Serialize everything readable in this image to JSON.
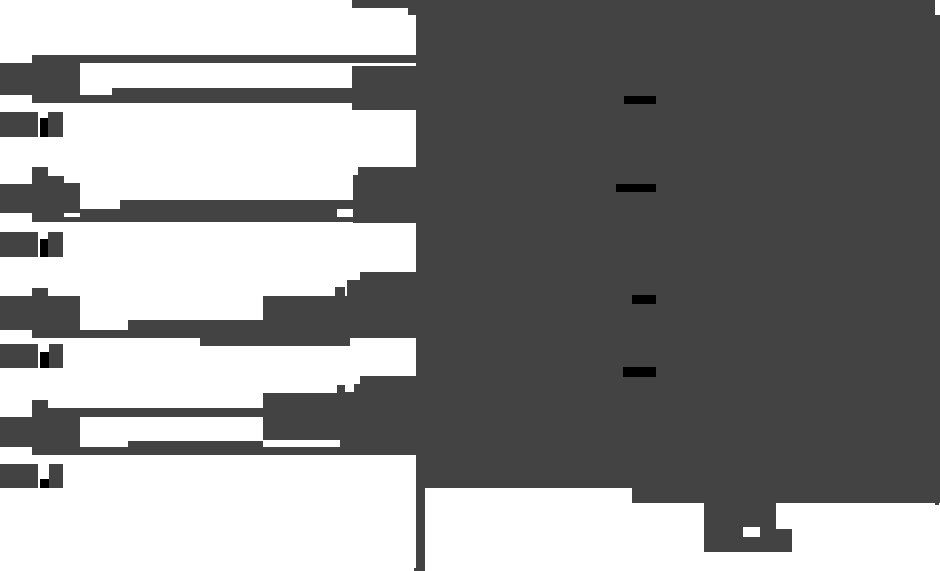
{
  "canvas": {
    "width": 940,
    "height": 571,
    "background": "#ffffff",
    "alt": "Pixelated monochrome silhouette of a web page: four list items with icon blocks and text lines on the left, large dark display panel with black text dashes and a monitor stand on the right"
  },
  "palette": {
    "dark": "#434343",
    "black": "#000000",
    "white": "#ffffff"
  },
  "shapes": [
    {
      "name": "panel-top-edge",
      "x": 352,
      "y": 0,
      "w": 583,
      "h": 8,
      "color": "dark"
    },
    {
      "name": "panel-top-step",
      "x": 408,
      "y": 8,
      "w": 527,
      "h": 7,
      "color": "dark"
    },
    {
      "name": "panel-body",
      "x": 416,
      "y": 15,
      "w": 524,
      "h": 473,
      "color": "dark"
    },
    {
      "name": "panel-bottom-extension",
      "x": 632,
      "y": 488,
      "w": 308,
      "h": 15,
      "color": "dark"
    },
    {
      "name": "panel-corner-nub",
      "x": 935,
      "y": 503,
      "w": 4,
      "h": 2,
      "color": "dark"
    },
    {
      "name": "divider-line",
      "x": 416,
      "y": 488,
      "w": 9,
      "h": 80,
      "color": "dark"
    },
    {
      "name": "divider-line-foot",
      "x": 414,
      "y": 568,
      "w": 11,
      "h": 3,
      "color": "dark"
    },
    {
      "name": "stand-column",
      "x": 704,
      "y": 503,
      "w": 72,
      "h": 26,
      "color": "dark"
    },
    {
      "name": "stand-base",
      "x": 704,
      "y": 529,
      "w": 88,
      "h": 23,
      "color": "dark"
    },
    {
      "name": "stand-base-notch",
      "x": 743,
      "y": 527,
      "w": 17,
      "h": 10,
      "color": "white"
    },
    {
      "name": "screen-dash-1",
      "x": 624,
      "y": 96,
      "w": 32,
      "h": 8,
      "color": "black"
    },
    {
      "name": "screen-dash-2",
      "x": 616,
      "y": 184,
      "w": 40,
      "h": 8,
      "color": "black"
    },
    {
      "name": "screen-dash-3",
      "x": 632,
      "y": 295,
      "w": 24,
      "h": 9,
      "color": "black"
    },
    {
      "name": "screen-dash-4",
      "x": 623,
      "y": 367,
      "w": 33,
      "h": 10,
      "color": "black"
    },
    {
      "name": "item1-title-line",
      "x": 32,
      "y": 55,
      "w": 384,
      "h": 8,
      "color": "dark"
    },
    {
      "name": "item1-icon-block",
      "x": 32,
      "y": 55,
      "w": 48,
      "h": 48,
      "color": "dark"
    },
    {
      "name": "item1-left-block",
      "x": 0,
      "y": 63,
      "w": 32,
      "h": 32,
      "color": "dark"
    },
    {
      "name": "item1-text-line-a",
      "x": 112,
      "y": 88,
      "w": 241,
      "h": 7,
      "color": "dark"
    },
    {
      "name": "item1-text-line-b",
      "x": 32,
      "y": 95,
      "w": 321,
      "h": 8,
      "color": "dark"
    },
    {
      "name": "item1-connector",
      "x": 352,
      "y": 66,
      "w": 64,
      "h": 44,
      "color": "dark"
    },
    {
      "name": "item1-caption-block-a",
      "x": 0,
      "y": 112,
      "w": 38,
      "h": 25,
      "color": "dark"
    },
    {
      "name": "item1-caption-cursor",
      "x": 40,
      "y": 118,
      "w": 8,
      "h": 19,
      "color": "black"
    },
    {
      "name": "item1-caption-block-b",
      "x": 48,
      "y": 112,
      "w": 15,
      "h": 25,
      "color": "dark"
    },
    {
      "name": "item2-tab",
      "x": 32,
      "y": 167,
      "w": 16,
      "h": 9,
      "color": "dark"
    },
    {
      "name": "item2-icon-block",
      "x": 32,
      "y": 176,
      "w": 32,
      "h": 46,
      "color": "dark"
    },
    {
      "name": "item2-left-block",
      "x": 0,
      "y": 184,
      "w": 32,
      "h": 29,
      "color": "dark"
    },
    {
      "name": "item2-icon-block-b",
      "x": 64,
      "y": 183,
      "w": 16,
      "h": 30,
      "color": "dark"
    },
    {
      "name": "item2-text-line-a",
      "x": 120,
      "y": 200,
      "w": 233,
      "h": 9,
      "color": "dark"
    },
    {
      "name": "item2-text-line-b",
      "x": 80,
      "y": 209,
      "w": 257,
      "h": 8,
      "color": "dark"
    },
    {
      "name": "item2-text-line-c",
      "x": 32,
      "y": 217,
      "w": 384,
      "h": 5,
      "color": "dark"
    },
    {
      "name": "item2-connector-step",
      "x": 358,
      "y": 167,
      "w": 58,
      "h": 8,
      "color": "dark"
    },
    {
      "name": "item2-connector",
      "x": 353,
      "y": 175,
      "w": 63,
      "h": 48,
      "color": "dark"
    },
    {
      "name": "item2-caption-block-a",
      "x": 0,
      "y": 232,
      "w": 38,
      "h": 25,
      "color": "dark"
    },
    {
      "name": "item2-caption-cursor",
      "x": 40,
      "y": 239,
      "w": 9,
      "h": 18,
      "color": "black"
    },
    {
      "name": "item2-caption-block-b",
      "x": 48,
      "y": 232,
      "w": 15,
      "h": 25,
      "color": "dark"
    },
    {
      "name": "item3-tab",
      "x": 32,
      "y": 288,
      "w": 16,
      "h": 8,
      "color": "dark"
    },
    {
      "name": "item3-icon-block",
      "x": 0,
      "y": 296,
      "w": 80,
      "h": 34,
      "color": "dark"
    },
    {
      "name": "item3-text-line-a",
      "x": 128,
      "y": 320,
      "w": 135,
      "h": 10,
      "color": "dark"
    },
    {
      "name": "item3-heavy-block",
      "x": 263,
      "y": 296,
      "w": 153,
      "h": 42,
      "color": "dark"
    },
    {
      "name": "item3-text-line-b",
      "x": 32,
      "y": 330,
      "w": 384,
      "h": 8,
      "color": "dark"
    },
    {
      "name": "item3-text-line-b2",
      "x": 200,
      "y": 338,
      "w": 150,
      "h": 8,
      "color": "dark"
    },
    {
      "name": "item3-notch",
      "x": 335,
      "y": 287,
      "w": 10,
      "h": 9,
      "color": "dark"
    },
    {
      "name": "item3-connector-step-a",
      "x": 360,
      "y": 272,
      "w": 56,
      "h": 8,
      "color": "dark"
    },
    {
      "name": "item3-connector-step-b",
      "x": 347,
      "y": 280,
      "w": 69,
      "h": 16,
      "color": "dark"
    },
    {
      "name": "item3-caption-block-a",
      "x": 0,
      "y": 344,
      "w": 38,
      "h": 24,
      "color": "dark"
    },
    {
      "name": "item3-caption-cursor",
      "x": 40,
      "y": 352,
      "w": 9,
      "h": 16,
      "color": "black"
    },
    {
      "name": "item3-caption-block-b",
      "x": 49,
      "y": 344,
      "w": 14,
      "h": 24,
      "color": "dark"
    },
    {
      "name": "item4-connector-step-a",
      "x": 360,
      "y": 376,
      "w": 56,
      "h": 8,
      "color": "dark"
    },
    {
      "name": "item4-connector-step-b",
      "x": 354,
      "y": 384,
      "w": 62,
      "h": 8,
      "color": "dark"
    },
    {
      "name": "item4-connector",
      "x": 340,
      "y": 392,
      "w": 76,
      "h": 62,
      "color": "dark"
    },
    {
      "name": "item4-notch",
      "x": 337,
      "y": 385,
      "w": 8,
      "h": 8,
      "color": "dark"
    },
    {
      "name": "item4-heavy-block",
      "x": 263,
      "y": 393,
      "w": 97,
      "h": 47,
      "color": "dark"
    },
    {
      "name": "item4-tab",
      "x": 32,
      "y": 400,
      "w": 16,
      "h": 8,
      "color": "dark"
    },
    {
      "name": "item4-title-line",
      "x": 32,
      "y": 408,
      "w": 231,
      "h": 9,
      "color": "dark"
    },
    {
      "name": "item4-icon-block",
      "x": 32,
      "y": 408,
      "w": 48,
      "h": 47,
      "color": "dark"
    },
    {
      "name": "item4-left-block",
      "x": 0,
      "y": 417,
      "w": 32,
      "h": 30,
      "color": "dark"
    },
    {
      "name": "item4-text-line-a",
      "x": 128,
      "y": 441,
      "w": 135,
      "h": 9,
      "color": "dark"
    },
    {
      "name": "item4-text-line-b",
      "x": 32,
      "y": 447,
      "w": 384,
      "h": 8,
      "color": "dark"
    },
    {
      "name": "item4-caption-block-a",
      "x": 0,
      "y": 464,
      "w": 38,
      "h": 24,
      "color": "dark"
    },
    {
      "name": "item4-caption-cursor",
      "x": 40,
      "y": 479,
      "w": 9,
      "h": 9,
      "color": "black"
    },
    {
      "name": "item4-caption-block-b",
      "x": 49,
      "y": 464,
      "w": 14,
      "h": 24,
      "color": "dark"
    }
  ]
}
